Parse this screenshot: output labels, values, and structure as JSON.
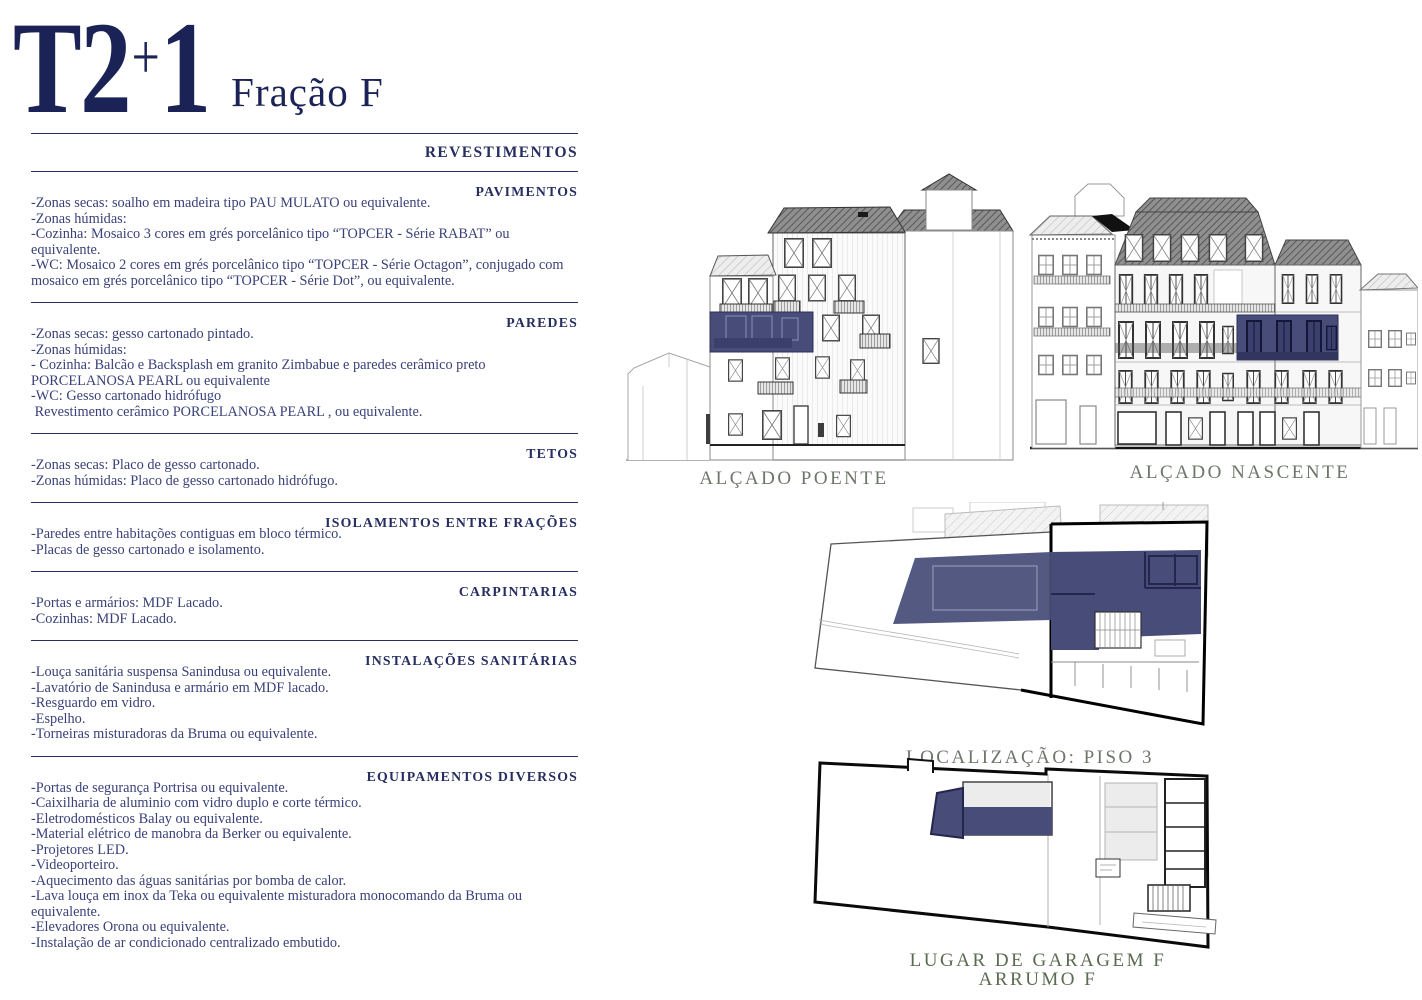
{
  "title": {
    "typology": "T2",
    "plus": "+",
    "one": "1",
    "fraction": "Fração F"
  },
  "colors": {
    "accent_navy_overlay": "#474c79",
    "heading_navy": "#272e60",
    "title_navy": "#1b2356",
    "body_navy": "#3a4178",
    "elevation_label_green": "#6d7669",
    "garage_label_green": "#5a6b50"
  },
  "spec": {
    "heading": "REVESTIMENTOS",
    "sections": [
      {
        "title": "PAVIMENTOS",
        "lines": [
          "-Zonas secas: soalho em madeira tipo PAU MULATO ou equivalente.",
          "-Zonas húmidas:",
          "-Cozinha: Mosaico 3 cores em grés porcelânico tipo “TOPCER - Série RABAT” ou equivalente.",
          "-WC: Mosaico 2 cores em grés porcelânico tipo “TOPCER - Série Octagon”, conjugado com mosaico em grés porcelânico tipo “TOPCER - Série Dot”, ou equivalente."
        ]
      },
      {
        "title": "PAREDES",
        "lines": [
          "-Zonas secas: gesso cartonado pintado.",
          "-Zonas húmidas:",
          "- Cozinha: Balcão e Backsplash em granito Zimbabue e paredes cerâmico preto PORCELANOSA PEARL ou equivalente",
          "-WC: Gesso cartonado hidrófugo",
          " Revestimento cerâmico PORCELANOSA PEARL , ou equivalente."
        ]
      },
      {
        "title": "TETOS",
        "lines": [
          "-Zonas secas: Placo de gesso cartonado.",
          "-Zonas húmidas: Placo de gesso cartonado hidrófugo."
        ]
      },
      {
        "title": "ISOLAMENTOS ENTRE FRAÇÕES",
        "lines": [
          "-Paredes entre habitações contiguas em bloco térmico.",
          "-Placas de gesso cartonado e isolamento."
        ]
      },
      {
        "title": "CARPINTARIAS",
        "lines": [
          "-Portas e armários: MDF Lacado.",
          "-Cozinhas: MDF Lacado."
        ]
      },
      {
        "title": "INSTALAÇÕES SANITÁRIAS",
        "lines": [
          "-Louça sanitária suspensa Sanindusa ou equivalente.",
          "-Lavatório de Sanindusa e armário em MDF lacado.",
          "-Resguardo em vidro.",
          "-Espelho.",
          "-Torneiras misturadoras da Bruma ou equivalente."
        ]
      },
      {
        "title": "EQUIPAMENTOS DIVERSOS",
        "lines": [
          "-Portas de segurança Portrisa ou equivalente.",
          "-Caixilharia de aluminio com vidro duplo e corte térmico.",
          "-Eletrodomésticos Balay ou equivalente.",
          "-Material elétrico de manobra da Berker ou equivalente.",
          "-Projetores LED.",
          "-Videoporteiro.",
          "-Aquecimento das águas sanitárias por bomba de calor.",
          "-Lava louça em inox da Teka ou equivalente misturadora monocomando da Bruma ou equivalente.",
          "-Elevadores Orona ou equivalente.",
          "-Instalação de ar condicionado centralizado embutido."
        ]
      }
    ]
  },
  "drawings": {
    "poente": {
      "label": "ALÇADO POENTE"
    },
    "nascente": {
      "label": "ALÇADO NASCENTE"
    },
    "piso3": {
      "label": "LOCALIZAÇÃO: PISO 3"
    },
    "garagem": {
      "label_line1": "LUGAR DE GARAGEM  F",
      "label_line2": "ARRUMO  F"
    }
  }
}
